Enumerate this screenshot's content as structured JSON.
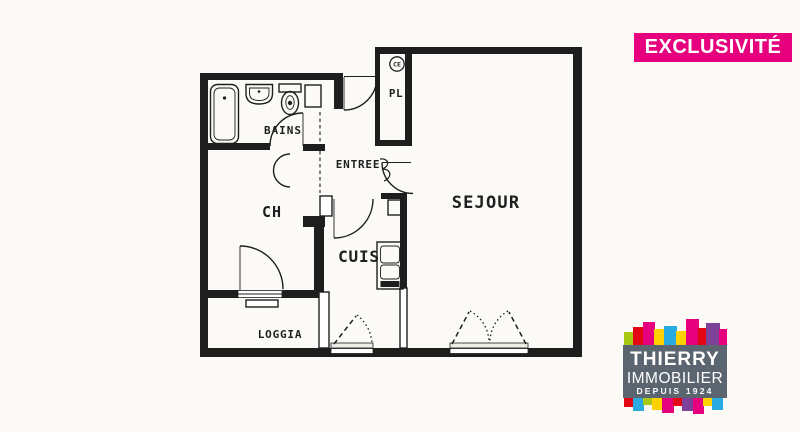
{
  "badge": {
    "label": "EXCLUSIVITÉ"
  },
  "rooms": {
    "bains": "BAINS",
    "ch": "CH",
    "entree": "ENTREE",
    "pl": "PL",
    "ce": "CE",
    "sejour": "SEJOUR",
    "cuis": "CUIS",
    "loggia": "LOGGIA"
  },
  "logo": {
    "name": "THIERRY",
    "line2": "IMMOBILIER",
    "line3": "DEPUIS 1924"
  },
  "colors": {
    "ink": "#1e1e1e",
    "paper": "#fbfaf7",
    "magenta": "#e6007e",
    "logo-gray": "#5b6570",
    "red": "#e30613",
    "yellow": "#ffd100",
    "cyan": "#29abe2",
    "lime": "#a8c813",
    "purple": "#7d4199"
  }
}
